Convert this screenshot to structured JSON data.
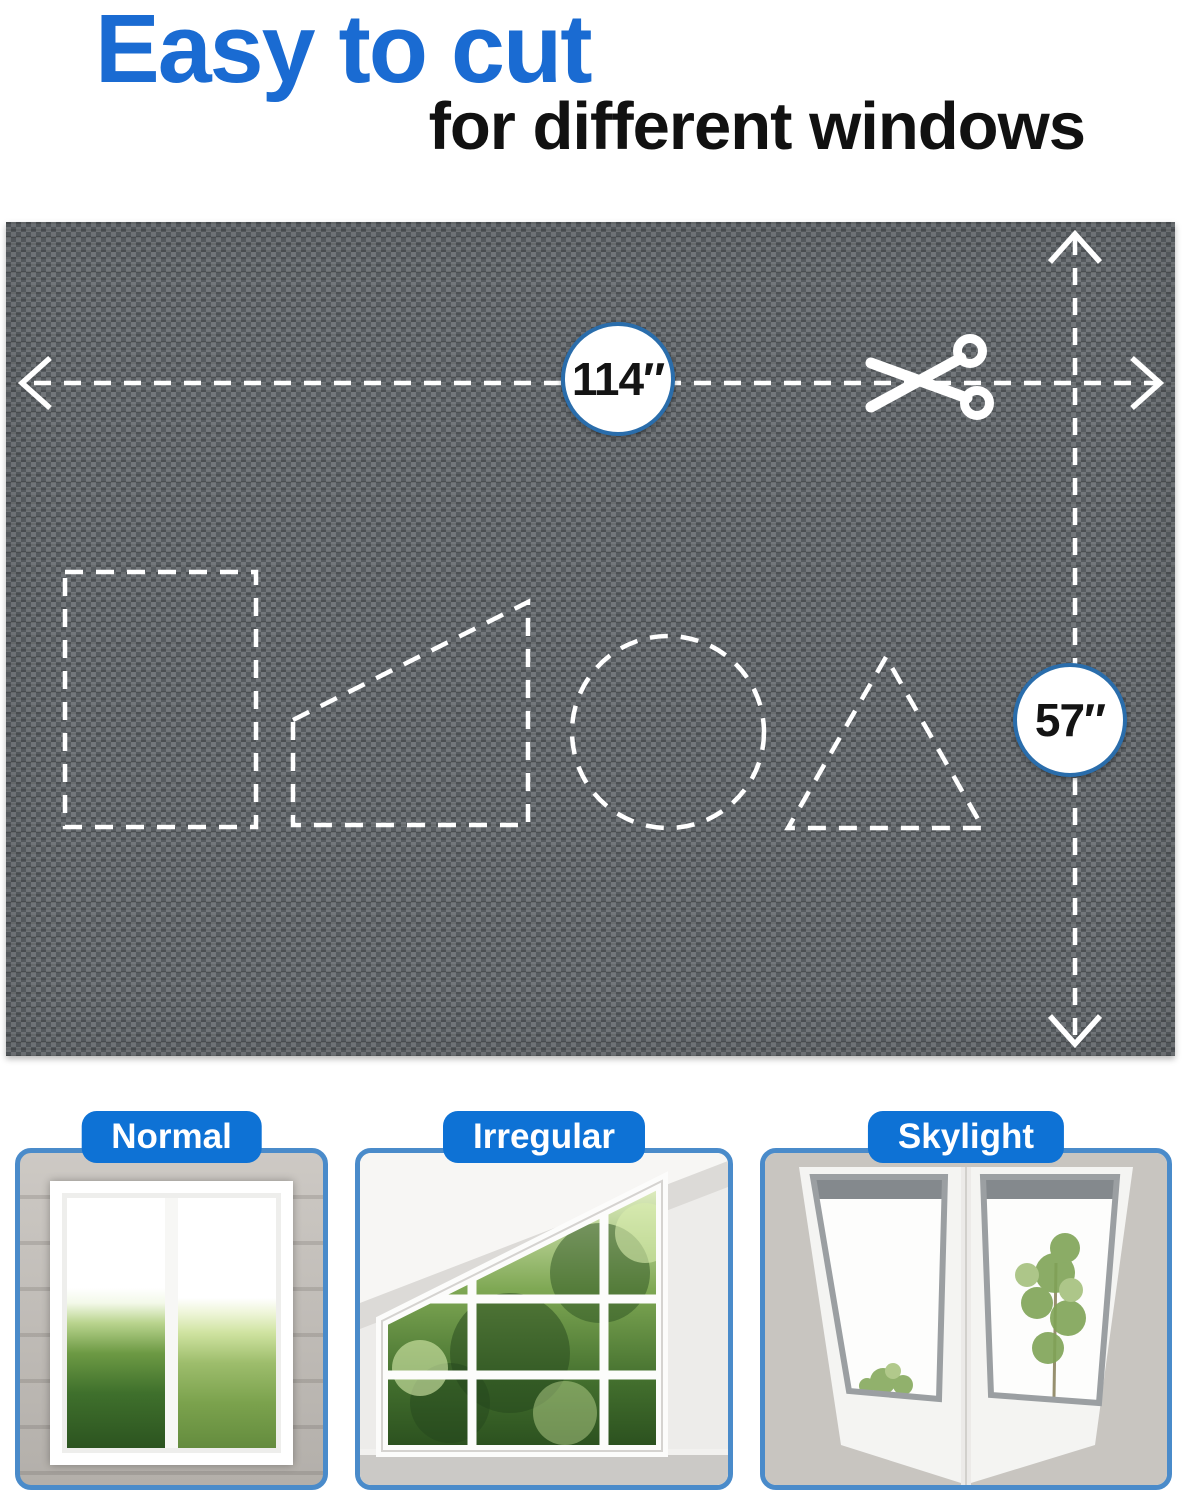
{
  "header": {
    "title": "Easy to cut",
    "subtitle": "for different windows"
  },
  "material": {
    "width_label": "114″",
    "height_label": "57″",
    "cut_guides": [
      "rectangle",
      "right-trapezoid",
      "circle",
      "triangle"
    ]
  },
  "icons": {
    "scissors": "✂",
    "width_arrow": "↔",
    "height_arrow": "↕"
  },
  "window_types": [
    {
      "label": "Normal"
    },
    {
      "label": "Irregular"
    },
    {
      "label": "Skylight"
    }
  ],
  "colors": {
    "title-blue": "#1a6bd2",
    "subtitle-black": "#111111",
    "pill-blue": "#0e72d5",
    "card-border-blue": "#4a8bca",
    "badge-ring-blue": "#2a6dab",
    "fabric-gray": "#575c60"
  }
}
